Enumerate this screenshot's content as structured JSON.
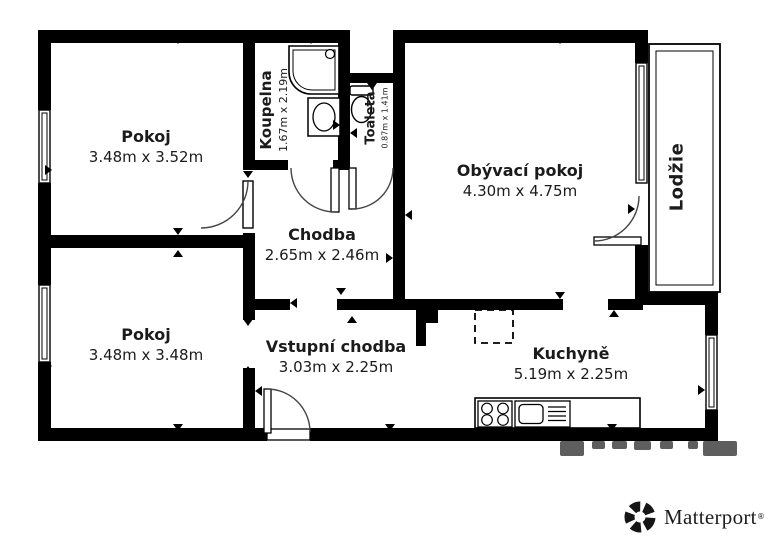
{
  "plan": {
    "rooms": [
      {
        "id": "pokoj-top",
        "name": "Pokoj",
        "dims": "3.48m x 3.52m"
      },
      {
        "id": "koupelna",
        "name": "Koupelna",
        "dims": "1.67m x 2.19m"
      },
      {
        "id": "toaleta",
        "name": "Toaleta",
        "dims": "0.87m x 1.41m"
      },
      {
        "id": "obyvaci-pokoj",
        "name": "Obývací pokoj",
        "dims": "4.30m x 4.75m"
      },
      {
        "id": "lodzie",
        "name": "Lodžie",
        "dims": ""
      },
      {
        "id": "chodba",
        "name": "Chodba",
        "dims": "2.65m x 2.46m"
      },
      {
        "id": "pokoj-bottom",
        "name": "Pokoj",
        "dims": "3.48m x 3.48m"
      },
      {
        "id": "vstupni-chodba",
        "name": "Vstupní chodba",
        "dims": "3.03m x 2.25m"
      },
      {
        "id": "kuchyne",
        "name": "Kuchyně",
        "dims": "5.19m x 2.25m"
      }
    ],
    "fixtures": [
      "shower-icon",
      "washbasin-icon",
      "toilet-icon",
      "stove-icon",
      "sink-icon",
      "kitchen-counter",
      "fridge-placeholder"
    ],
    "colors": {
      "wall": "#000000",
      "arc": "#444444",
      "watermark": "#4d4d4d"
    }
  },
  "branding": {
    "logo_text": "Matterport",
    "trademark_mark": "®"
  }
}
